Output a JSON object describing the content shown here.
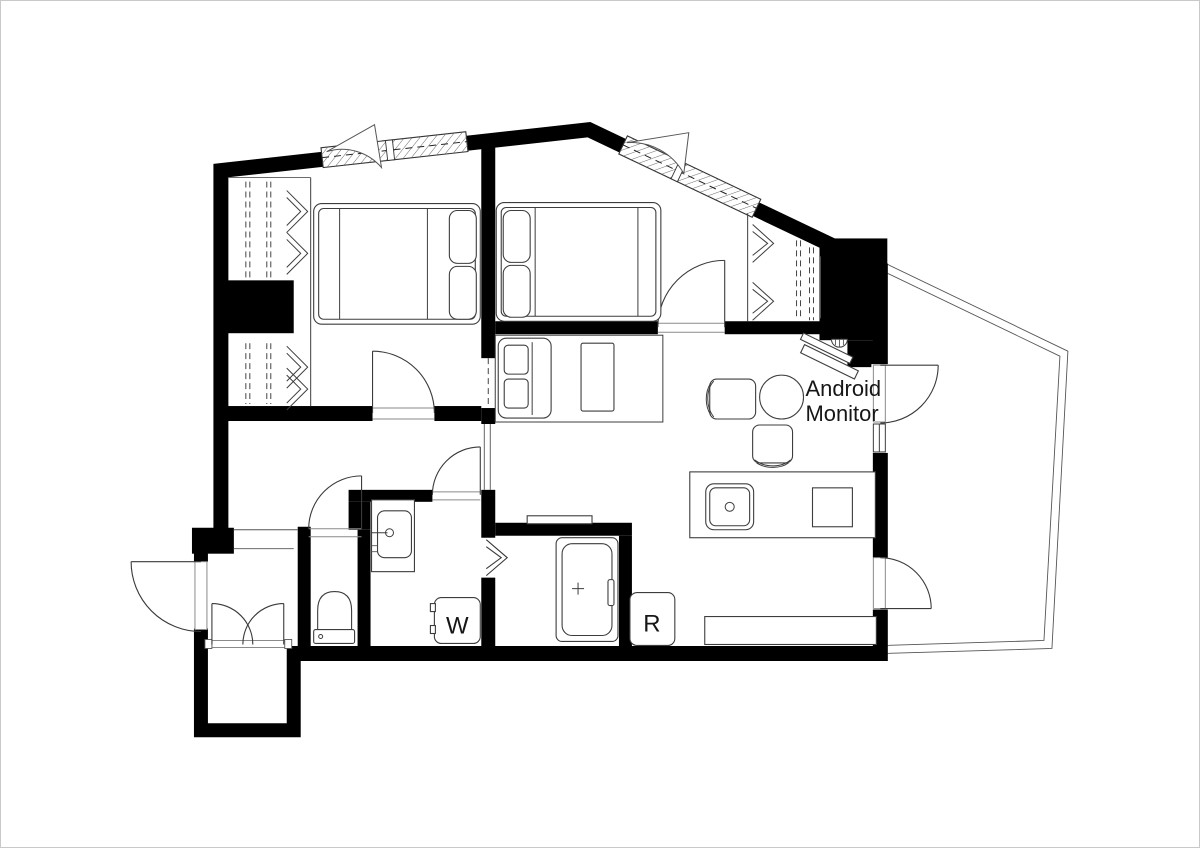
{
  "title": "apartment-floor-plan",
  "colors": {
    "wall": "#000000",
    "line": "#3d3d3d",
    "background": "#ffffff",
    "text": "#161616"
  },
  "labels": {
    "monitor_line1": "Android",
    "monitor_line2": "Monitor",
    "washing_machine": "W",
    "refrigerator": "R"
  },
  "icons": {
    "bed": "double-bed-plan-symbol",
    "closet_hanger": "chevron-hanger-symbol",
    "door": "quarter-arc-swing-symbol",
    "window": "hatched-bay-window-symbol",
    "sink": "kitchen-sink-symbol",
    "bathtub": "bathtub-symbol",
    "toilet": "toilet-symbol"
  }
}
